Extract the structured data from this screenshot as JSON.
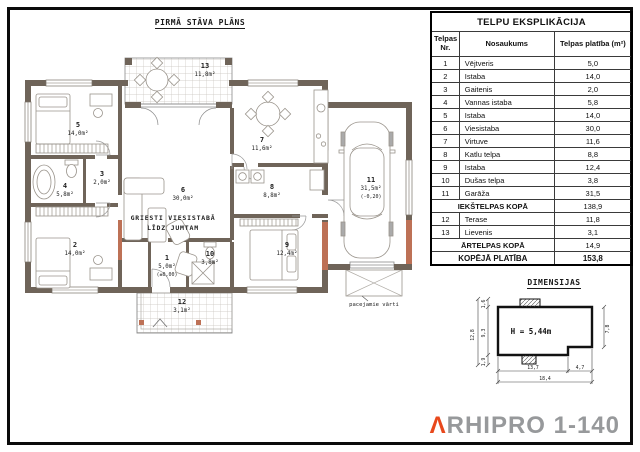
{
  "plan": {
    "title": "PIRMĀ STĀVA PLĀNS",
    "ceiling_note_1": "GRIESTI VIESISTABĀ",
    "ceiling_note_2": "LĪDZ JUMTAM",
    "gate_label": "pacejamie vārti",
    "rooms": {
      "r1": {
        "nr": "1",
        "area": "5,0m²",
        "note": "(±0,00)"
      },
      "r2": {
        "nr": "2",
        "area": "14,0m²"
      },
      "r3": {
        "nr": "3",
        "area": "2,0m²"
      },
      "r4": {
        "nr": "4",
        "area": "5,8m²"
      },
      "r5": {
        "nr": "5",
        "area": "14,0m²"
      },
      "r6": {
        "nr": "6",
        "area": "30,0m²"
      },
      "r7": {
        "nr": "7",
        "area": "11,6m²"
      },
      "r8": {
        "nr": "8",
        "area": "8,8m²"
      },
      "r9": {
        "nr": "9",
        "area": "12,4m²"
      },
      "r10": {
        "nr": "10",
        "area": "3,8m²"
      },
      "r11": {
        "nr": "11",
        "area": "31,5m²",
        "note": "(-0,20)"
      },
      "r12": {
        "nr": "12",
        "area": "3,1m²"
      },
      "r13": {
        "nr": "13",
        "area": "11,8m²"
      }
    }
  },
  "table": {
    "title": "TELPU EKSPLIKĀCIJA",
    "col_nr_line1": "Telpas",
    "col_nr_line2": "Nr.",
    "col_name": "Nosaukums",
    "col_area": "Telpas platība (m²)",
    "rows": [
      {
        "nr": "1",
        "name": "Vējtveris",
        "area": "5,0"
      },
      {
        "nr": "2",
        "name": "Istaba",
        "area": "14,0"
      },
      {
        "nr": "3",
        "name": "Gaitenis",
        "area": "2,0"
      },
      {
        "nr": "4",
        "name": "Vannas istaba",
        "area": "5,8"
      },
      {
        "nr": "5",
        "name": "Istaba",
        "area": "14,0"
      },
      {
        "nr": "6",
        "name": "Viesistaba",
        "area": "30,0"
      },
      {
        "nr": "7",
        "name": "Virtuve",
        "area": "11,6"
      },
      {
        "nr": "8",
        "name": "Katlu telpa",
        "area": "8,8"
      },
      {
        "nr": "9",
        "name": "Istaba",
        "area": "12,4"
      },
      {
        "nr": "10",
        "name": "Dušas telpa",
        "area": "3,8"
      },
      {
        "nr": "11",
        "name": "Garāža",
        "area": "31,5"
      },
      {
        "name": "IEKŠTELPAS KOPĀ",
        "area": "138,9"
      },
      {
        "nr": "12",
        "name": "Terase",
        "area": "11,8"
      },
      {
        "nr": "13",
        "name": "Lievenis",
        "area": "3,1"
      },
      {
        "name": "ĀRTELPAS KOPĀ",
        "area": "14,9"
      },
      {
        "name": "KOPĒJĀ PLATĪBA",
        "area": "153,8"
      }
    ]
  },
  "dimensions": {
    "title": "DIMENSIJAS",
    "height_label": "H = 5,44m",
    "left_total": "12,8",
    "left_top": "1,6",
    "left_main": "9,3",
    "left_bottom": "1,9",
    "right": "7,8",
    "bottom_main": "13,7",
    "bottom_ext": "4,7",
    "bottom_total": "18,4"
  },
  "logo": {
    "mark": "Λ",
    "text": "RHIPRO 1-140",
    "mark_color": "#e8481c",
    "text_color": "#97999b"
  },
  "colors": {
    "wall": "#6f6459",
    "accent": "#bd7156"
  }
}
